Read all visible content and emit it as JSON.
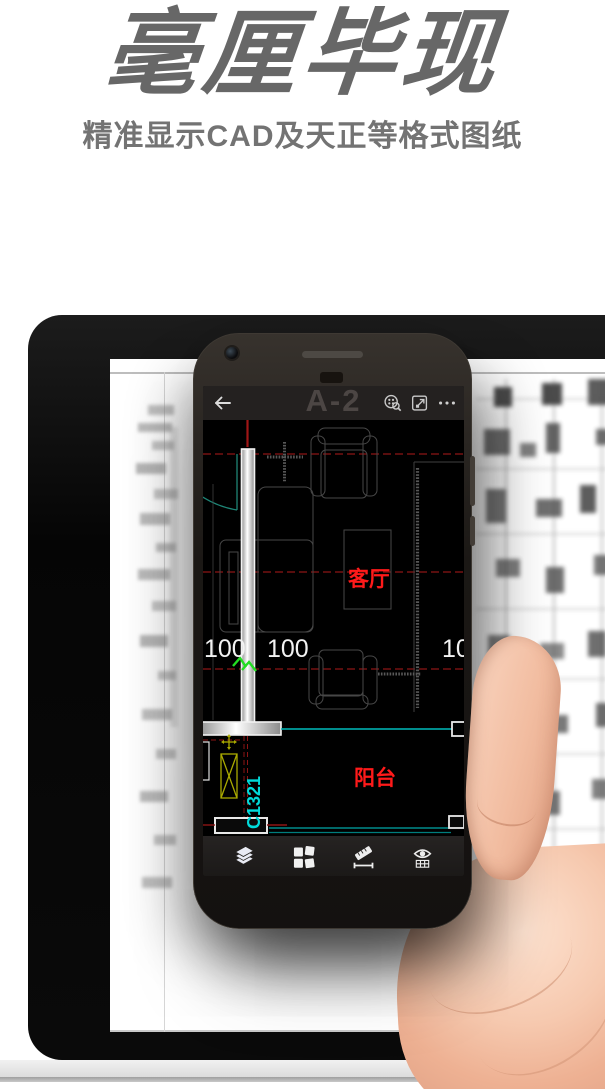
{
  "header": {
    "title": "毫厘毕现",
    "subtitle": "精准显示CAD及天正等格式图纸"
  },
  "phone": {
    "app_bar": {
      "title": "A-2",
      "icons": [
        "back-arrow-icon",
        "find-block-icon",
        "zoom-extents-icon",
        "more-icon"
      ]
    },
    "drawing": {
      "room_labels": [
        {
          "text": "客厅"
        },
        {
          "text": "阳台"
        }
      ],
      "window_tag": "C1321",
      "dimensions": [
        "100",
        "100",
        "10"
      ]
    },
    "toolbar_icons": [
      "layers-icon",
      "blocks-icon",
      "measure-icon",
      "display-icon"
    ]
  },
  "colors": {
    "label_red": "#ff1a1a",
    "tag_cyan": "#00dada",
    "break_green": "#22dd22",
    "dash_red": "#8d1515",
    "wall_light": "#e8e8e8"
  }
}
